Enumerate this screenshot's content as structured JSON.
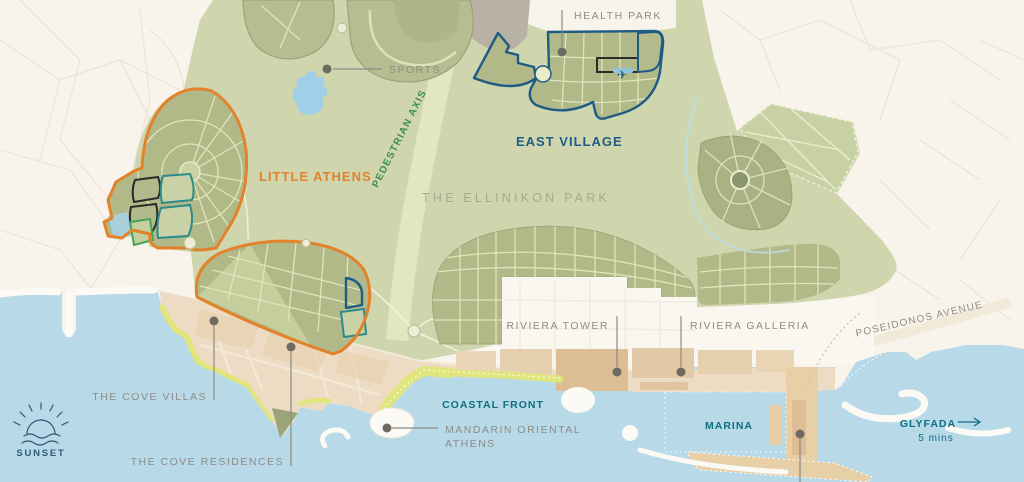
{
  "map": {
    "regions": {
      "park_title": "THE ELLINIKON PARK",
      "east_village": "EAST VILLAGE",
      "little_athens": "LITTLE ATHENS",
      "health_park": "HEALTH PARK",
      "sports": "SPORTS",
      "pedestrian_axis": "PEDESTRIAN AXIS"
    },
    "places": {
      "riviera_tower": "RIVIERA TOWER",
      "riviera_galleria": "RIVIERA GALLERIA",
      "cove_villas": "THE COVE VILLAS",
      "cove_residences": "THE COVE RESIDENCES",
      "coastal_front": "COASTAL FRONT",
      "mandarin_line1": "MANDARIN ORIENTAL",
      "mandarin_line2": "ATHENS",
      "marina": "MARINA",
      "poseidonos_avenue": "POSEIDONOS AVENUE",
      "glyfada": "GLYFADA",
      "glyfada_time": "5 mins"
    },
    "logo": {
      "name": "SUNSET"
    },
    "icons": {
      "plane": "✈"
    },
    "colors": {
      "background": "#f8f4ec",
      "park_green": "#cfd6ae",
      "block_olive": "#b1b989",
      "block_line": "#e0e4ba",
      "sports_green": "#b6be91",
      "axis_band": "#e3e7c1",
      "sea": "#b7d9e8",
      "beach": "#e0e57d",
      "sand": "#eddcc3",
      "sand_block": "#dcbd94",
      "white_zone": "#faf7f0",
      "gray_block": "#b7b1a6",
      "lake_blue": "#9fd0e8",
      "orange": "#e2832c",
      "navy": "#1e5b85",
      "teal": "#2d8a8a",
      "green_outline": "#44a356",
      "black_outline": "#2b2b28",
      "teal_label": "#0f6f80",
      "green_label": "#3e8e50",
      "gray_label": "#8e8c84",
      "park_title": "#a7aa90",
      "logo_navy": "#2d5977",
      "leader": "#8b8b83",
      "dot": "#6e6a5f"
    }
  }
}
